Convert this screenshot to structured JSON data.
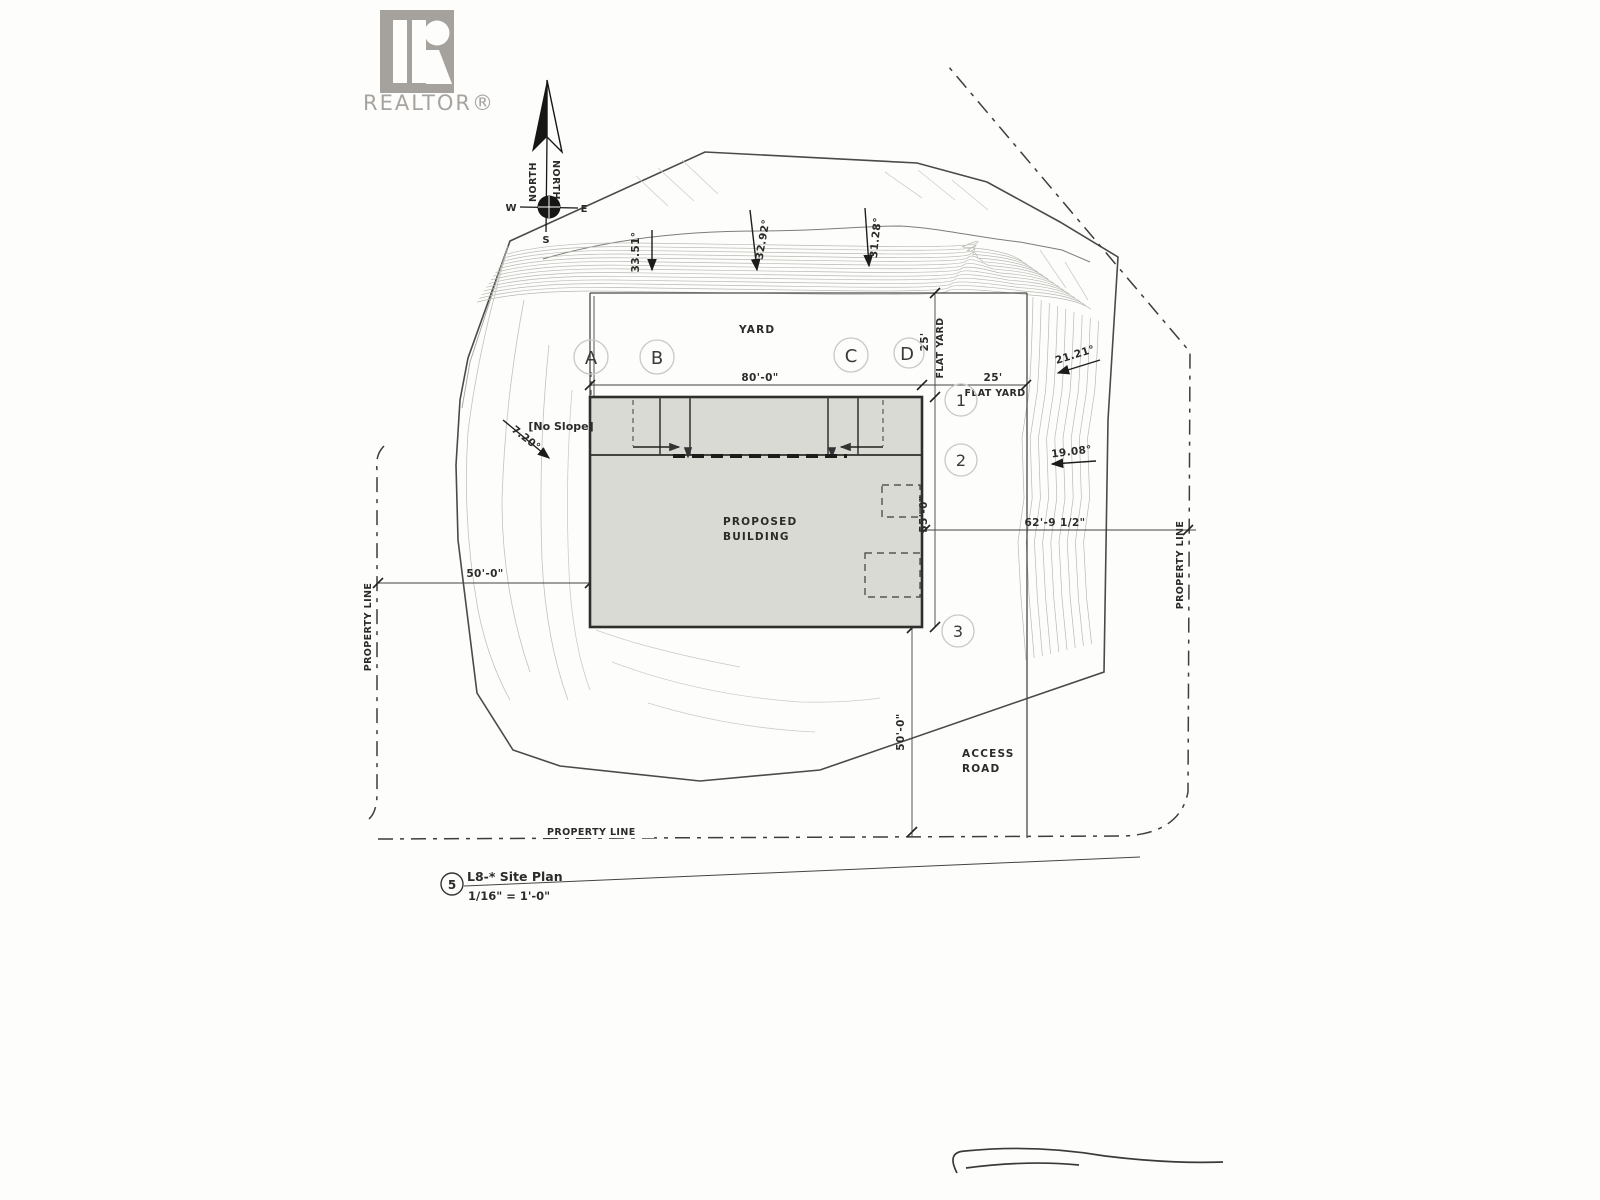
{
  "logo": {
    "brand": "REALTOR®"
  },
  "compass": {
    "north_left": "NORTH",
    "north_right": "NORTH",
    "west": "W",
    "east": "E",
    "south": "S"
  },
  "slopes": {
    "north_1": "33.51°",
    "north_2": "32.92°",
    "north_3": "31.28°",
    "east_1": "21.21°",
    "east_2": "19.08°",
    "west_1": "7.20°",
    "no_slope": "[No Slope]"
  },
  "areas": {
    "yard": "YARD",
    "flat_yard_vertical": {
      "dim": "25'",
      "label": "FLAT YARD"
    },
    "flat_yard_horizontal": {
      "dim": "25'",
      "label": "FLAT YARD"
    },
    "building_line1": "PROPOSED",
    "building_line2": "BUILDING",
    "access_road_line1": "ACCESS",
    "access_road_line2": "ROAD"
  },
  "property_lines": {
    "west": "PROPERTY LINE",
    "east": "PROPERTY LINE",
    "south": "PROPERTY LINE"
  },
  "grid": {
    "columns": [
      "A",
      "B",
      "C",
      "D"
    ],
    "rows": [
      "1",
      "2",
      "3"
    ]
  },
  "dimensions": {
    "building_width": "80'-0\"",
    "building_depth": "55'-0\"",
    "west_setback": "50'-0\"",
    "east_to_property": "62'-9 1/2\"",
    "road_length": "50'-0\""
  },
  "titleblock": {
    "detail_number": "5",
    "title": "L8-* Site Plan",
    "scale": "1/16\" = 1'-0\""
  }
}
